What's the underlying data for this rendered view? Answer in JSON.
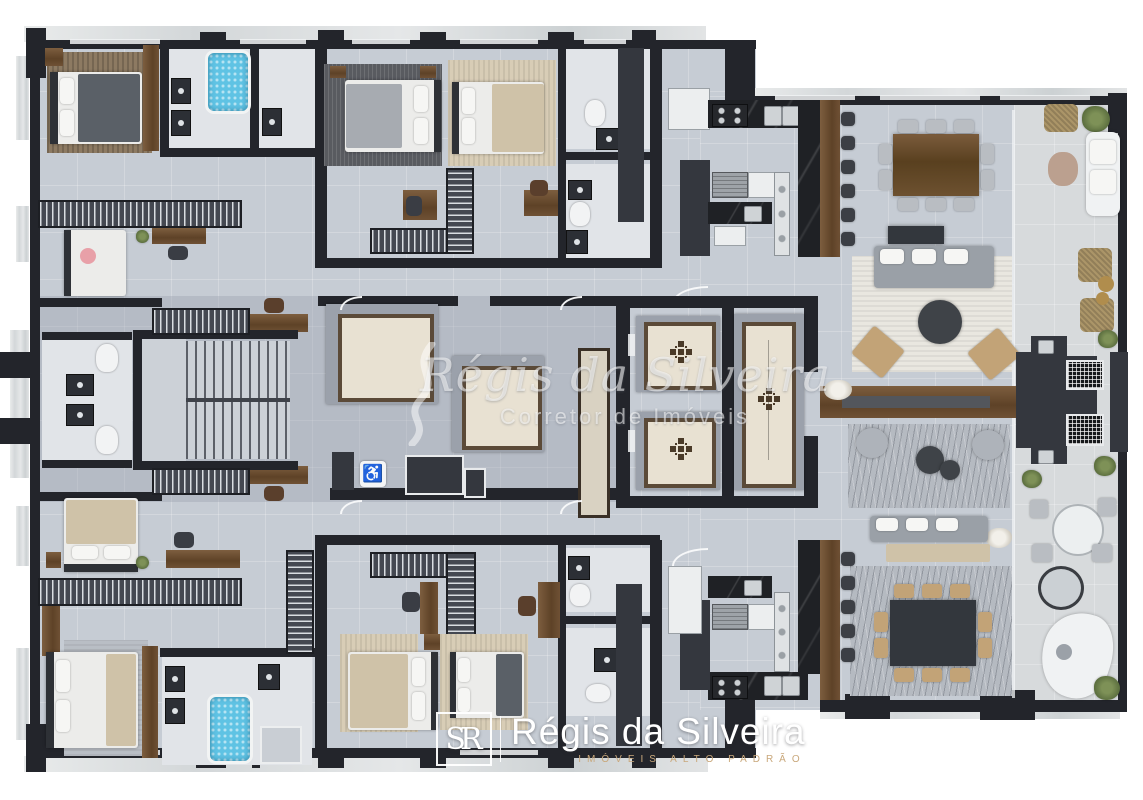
{
  "watermark": {
    "brand": "Régis da Silveira",
    "subtitle": "Corretor de Imóveis"
  },
  "footer": {
    "monogram": "SR",
    "brand": "Régis da Silveira",
    "tagline": "IMÓVEIS ALTO PADRÃO"
  },
  "symbols": {
    "accessible": "♿"
  },
  "palette": {
    "background": "#ffffff",
    "floor": "#c6ccd4",
    "corridor": "#aab1bc",
    "bath_floor": "#e1e4e8",
    "terrace": "#d7dadc",
    "wall": "#23252b",
    "wood": "#6f5135",
    "marble_trim": "#dfe2e3",
    "water_blue": "#5fc3e4",
    "elevator_floor": "#e8e1d2",
    "elevator_border": "#5b4a38",
    "rug_light": "#e9e7e0",
    "rug_wavy": "#b5bac1",
    "rug_brown": "#8d7a62",
    "armchair_tan": "#c2a377",
    "logo_tan": "#c9a87c",
    "watermark_white": "rgba(255,255,255,0.55)",
    "pink_pillow": "#e8a0a8",
    "plant_green": "#6d8049"
  }
}
